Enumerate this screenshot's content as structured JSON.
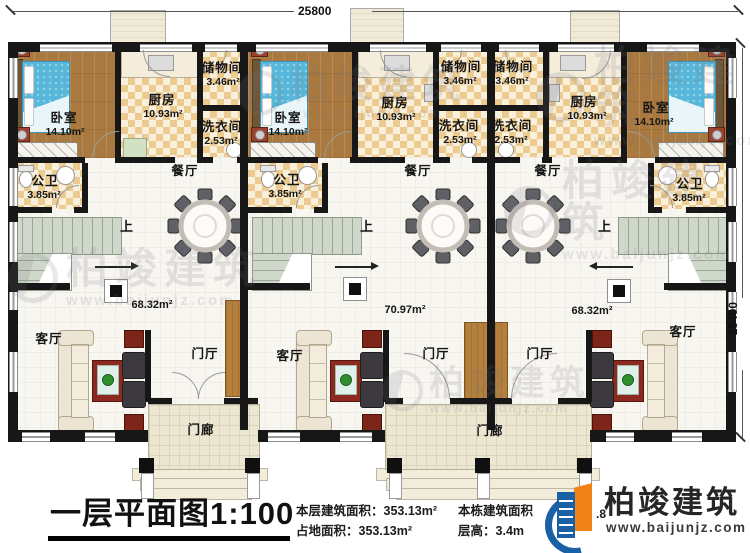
{
  "dims": {
    "top": "25800",
    "right": "15400"
  },
  "labels": {
    "bedroom": "卧室",
    "bedroom_area": "14.10m²",
    "kitchen": "厨房",
    "kitchen_area": "10.93m²",
    "storage": "储物间",
    "storage_area": "3.46m²",
    "laundry": "洗衣间",
    "laundry_area": "2.53m²",
    "bath": "公卫",
    "bath_area": "3.85m²",
    "dining": "餐厅",
    "living": "客厅",
    "foyer": "门厅",
    "porch": "门廊",
    "up": "上",
    "area_left": "68.32m²",
    "area_center": "70.97m²",
    "area_right": "68.32m²"
  },
  "footer": {
    "title": "一层平面图",
    "scale": "1:100",
    "stats": {
      "floor_area_label": "本层建筑面积：",
      "floor_area_value": "353.13m²",
      "land_area_label": "占地面积：",
      "land_area_value": "353.13m²",
      "total_area_label": "本栋建筑面积",
      "total_area_partial": ".8",
      "floor_height_label": "层高：",
      "floor_height_value": "3.4m"
    }
  },
  "brand": {
    "name": "柏竣建筑",
    "url": "www.baijunjz.com"
  },
  "watermark": {
    "name": "柏竣建筑",
    "url": "www.baijunjz.com"
  }
}
